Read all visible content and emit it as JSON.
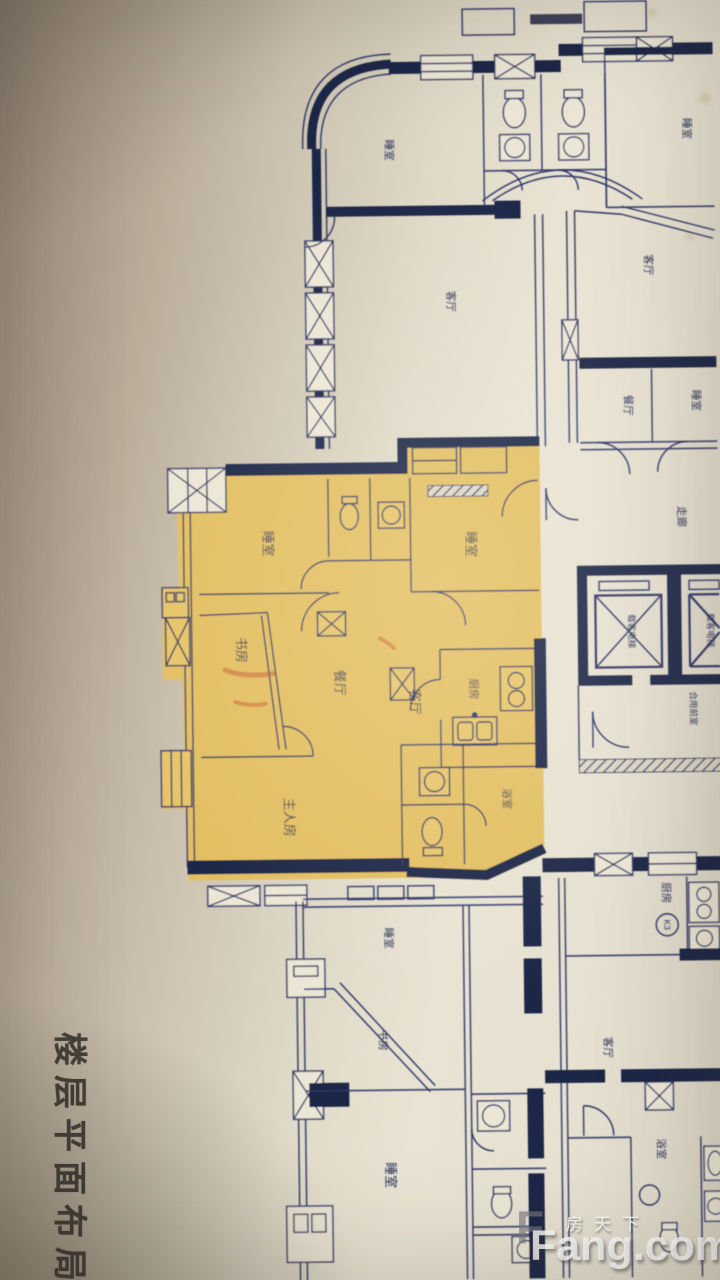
{
  "page": {
    "title_vertical": "楼层平面布局图"
  },
  "watermark": {
    "logo_letter": "F",
    "brand_cn": "房天下",
    "brand_en": "Fang.com"
  },
  "floorplan": {
    "colors": {
      "highlight": "#e3bf62",
      "line": "#2d3566",
      "wall": "#1c2547",
      "paper": "#e9e3d3",
      "marker": "#c9602f"
    },
    "highlighted_unit": {
      "bedroom1": "睡室",
      "bedroom2": "睡室",
      "study": "书房",
      "dining": "餐厅",
      "living": "客厅",
      "kitchen": "厨房",
      "master": "主人房",
      "bath": "浴室"
    },
    "top_unit": {
      "bedroom1": "睡室",
      "bedroom2": "睡室",
      "living": "客厅"
    },
    "right_unit": {
      "living": "客厅",
      "dining": "餐厅",
      "bedroom": "睡室",
      "hall": "走廊"
    },
    "core": {
      "elevator1": "载客电梯",
      "elevator2": "载客电梯",
      "lobby": "合用前室"
    },
    "bottom_unit": {
      "bedroom1": "睡室",
      "study": "书房",
      "bedroom2": "睡室"
    },
    "bottom_right_unit": {
      "kitchen": "厨房",
      "kitchen_code": "K3",
      "living": "客厅",
      "bath": "浴室"
    }
  }
}
